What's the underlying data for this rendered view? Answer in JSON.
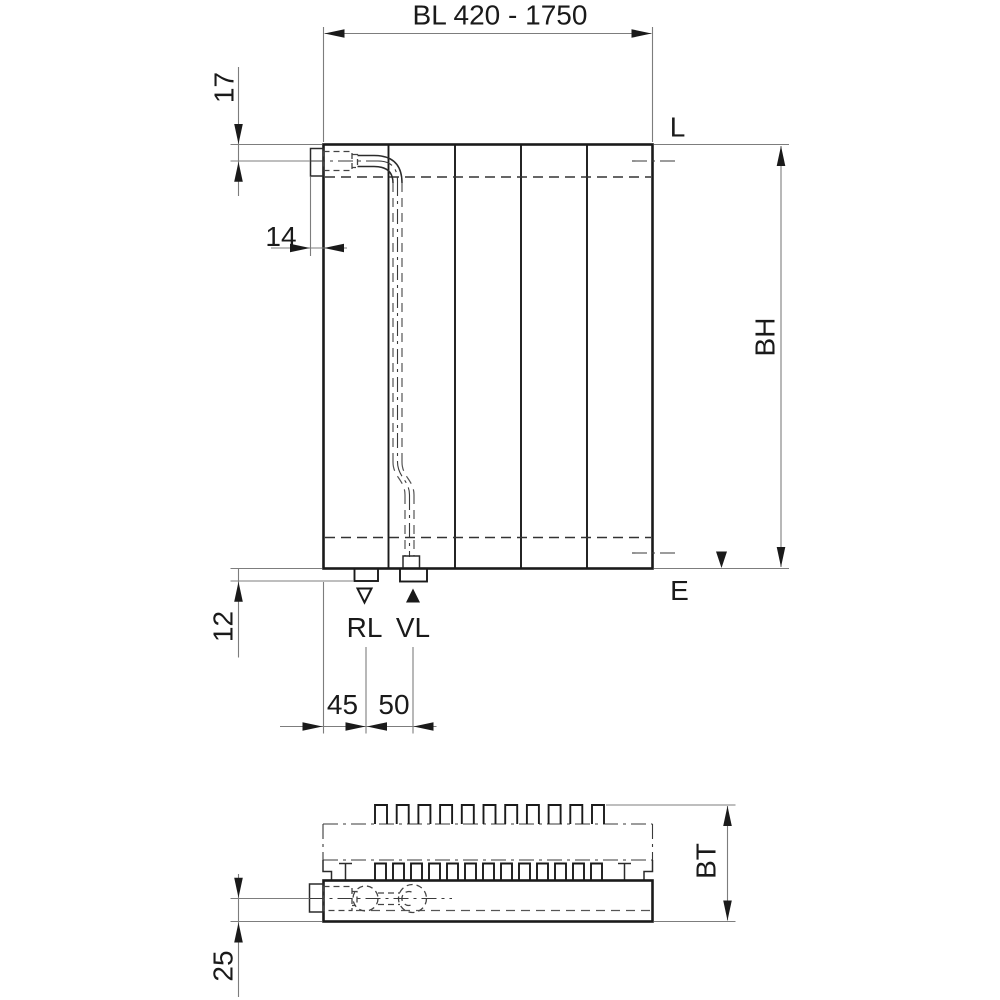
{
  "drawing": {
    "front_view": {
      "width_dim": "BL 420 - 1750",
      "top_connection_offset_dim": "17",
      "bracket_depth_dim": "14",
      "height_dim": "BH",
      "vent_label": "L",
      "drain_label": "E",
      "bottom_connection_offset_dim": "12",
      "return_connection_label": "RL",
      "supply_connection_label": "VL",
      "return_spacing_dim": "45",
      "supply_spacing_dim": "50"
    },
    "bottom_view": {
      "depth_dim": "BT",
      "connection_axis_offset_dim": "25"
    },
    "colors": {
      "line": "#1a1a1a",
      "thin_line": "#7d7d7d",
      "background": "#ffffff"
    }
  }
}
